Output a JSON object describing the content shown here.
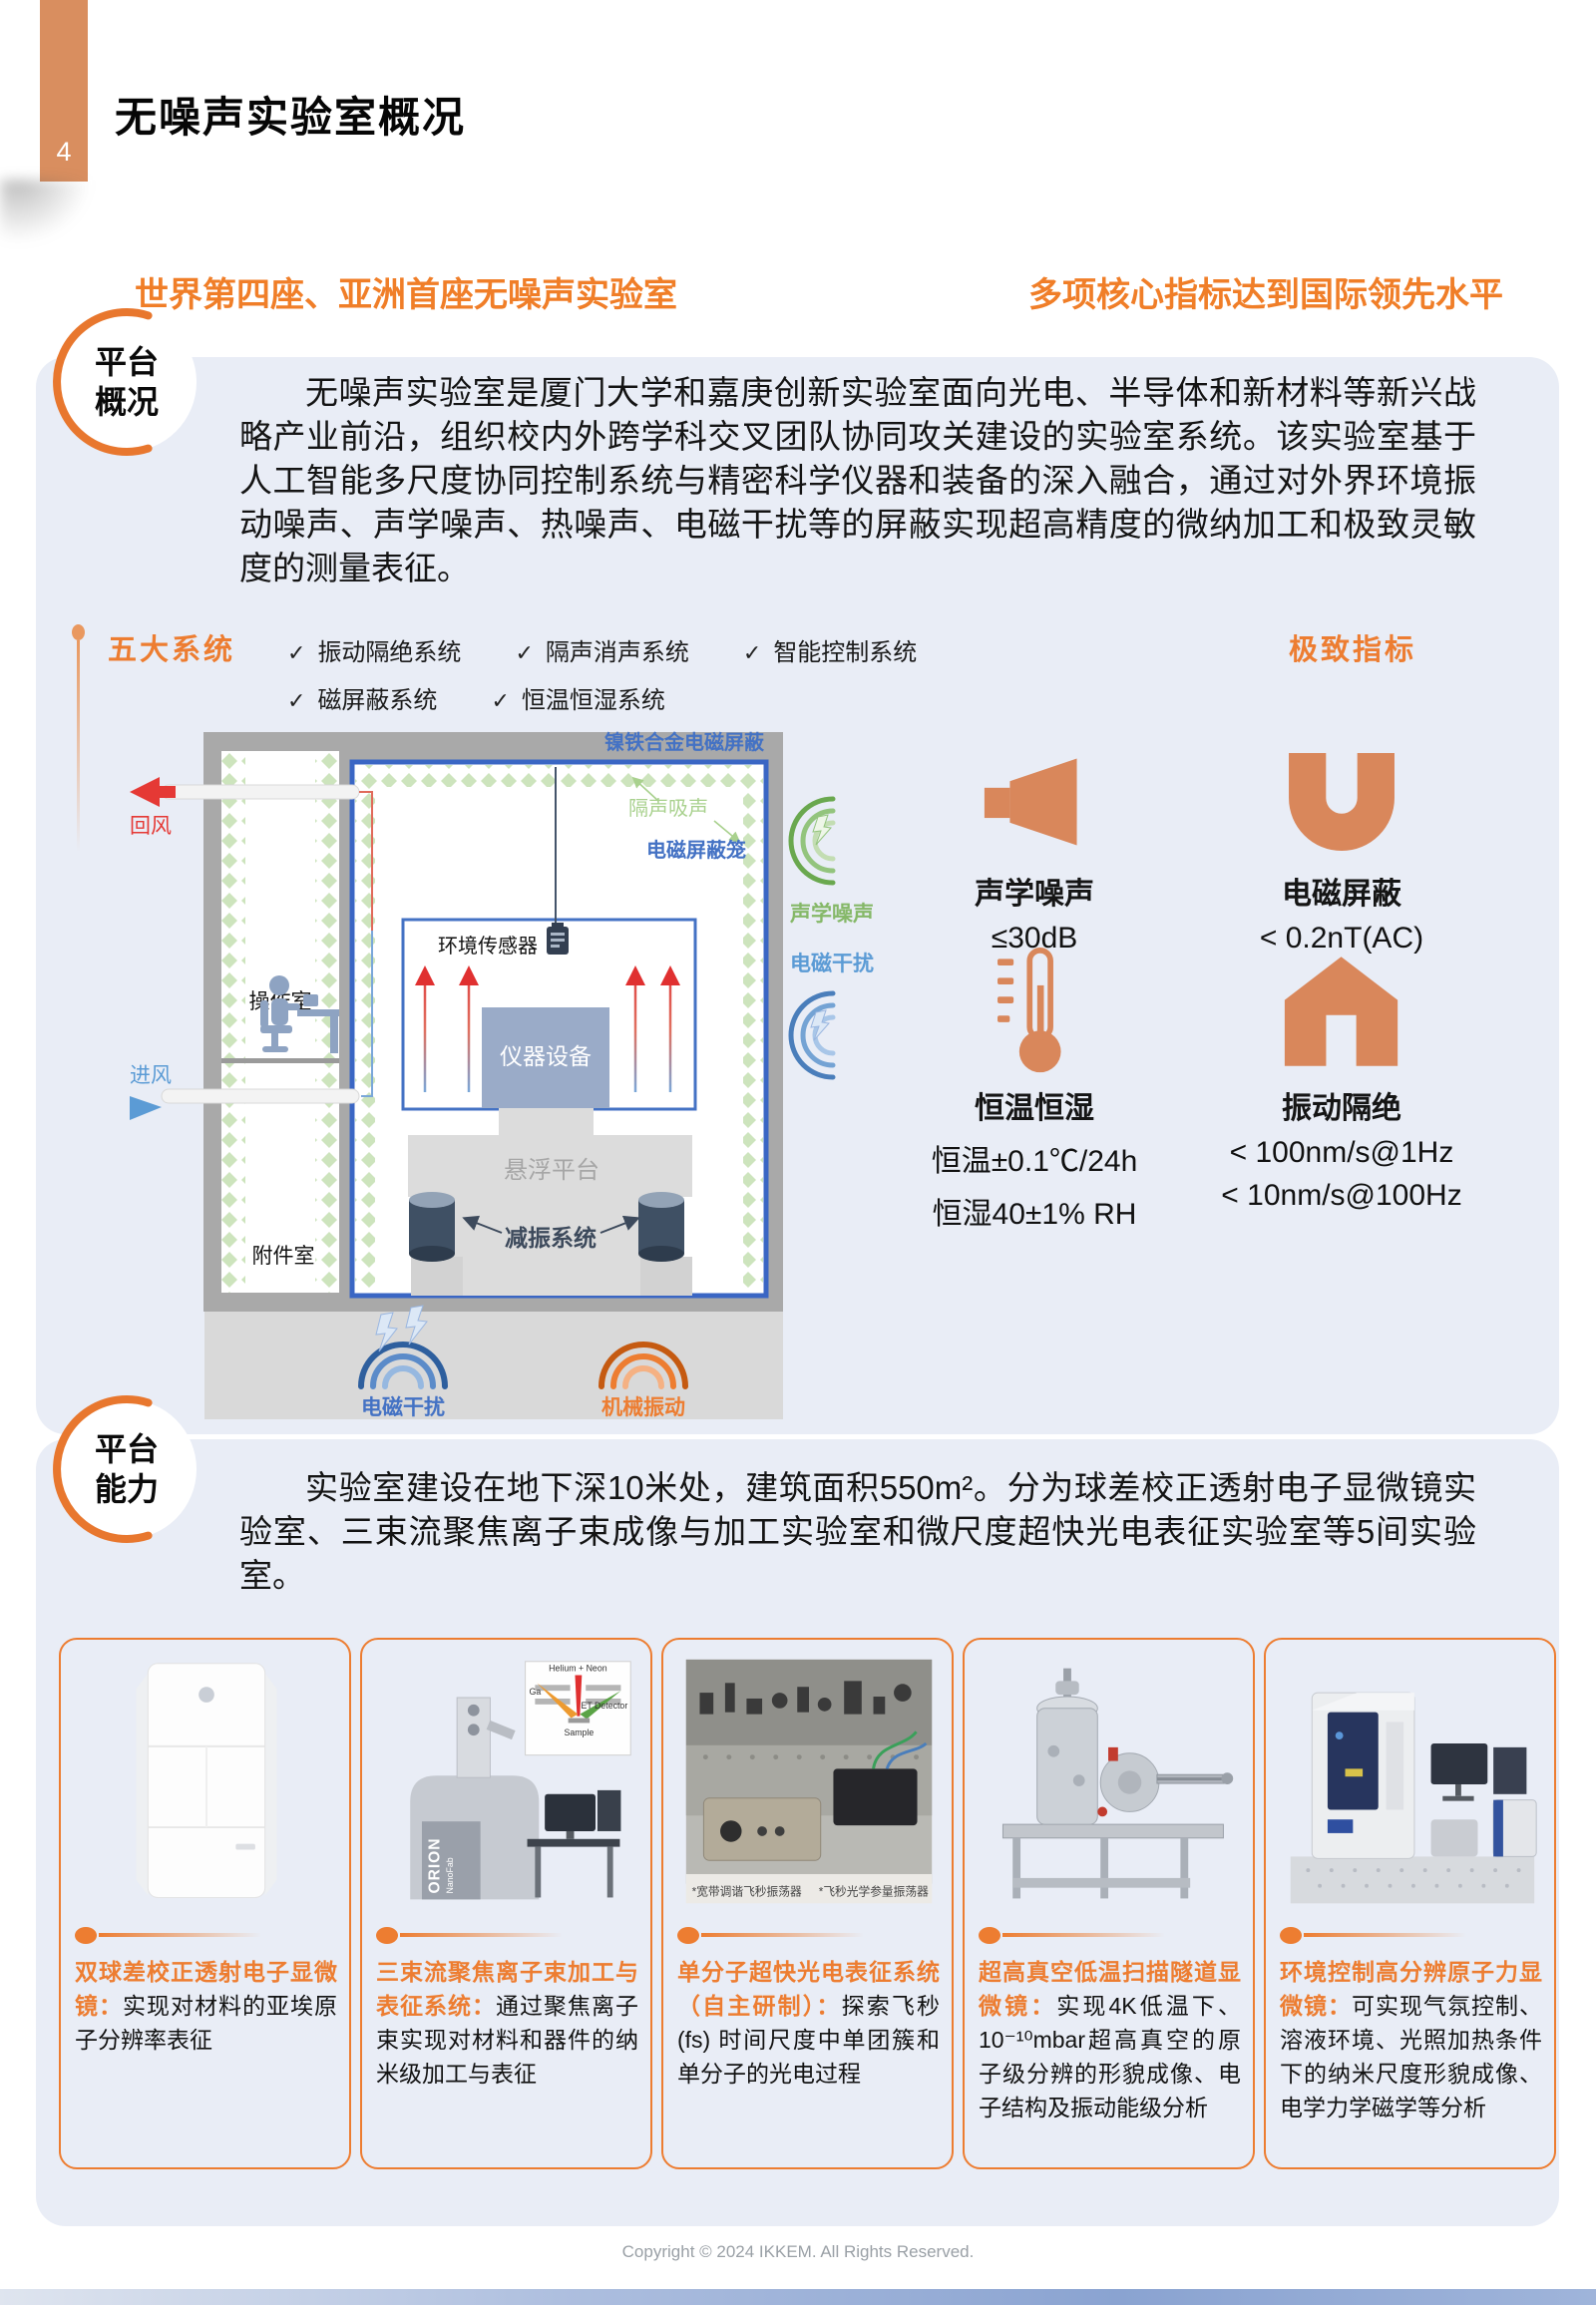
{
  "colors": {
    "accent": "#ED7D31",
    "tab_orange": "#D98E5F",
    "panel_blue": "#E9EDF6",
    "diagram_blue": "#4472C4",
    "diagram_green": "#A9D18E",
    "icon_orange": "#D9875B"
  },
  "page": {
    "number": "4",
    "title": "无噪声实验室概况",
    "headline_left": "世界第四座、亚洲首座无噪声实验室",
    "headline_right": "多项核心指标达到国际领先水平",
    "footer": "Copyright © 2024 IKKEM. All Rights Reserved."
  },
  "section1": {
    "badge": {
      "line1": "平台",
      "line2": "概况"
    },
    "paragraph": "无噪声实验室是厦门大学和嘉庚创新实验室面向光电、半导体和新材料等新兴战略产业前沿，组织校内外跨学科交叉团队协同攻关建设的实验室系统。该实验室基于人工智能多尺度协同控制系统与精密科学仪器和装备的深入融合，通过对外界环境振动噪声、声学噪声、热噪声、电磁干扰等的屏蔽实现超高精度的微纳加工和极致灵敏度的测量表征。",
    "systems_title": "五大系统",
    "check": "✓",
    "systems": [
      "振动隔绝系统",
      "隔声消声系统",
      "智能控制系统",
      "磁屏蔽系统",
      "恒温恒湿系统"
    ],
    "metrics_title": "极致指标",
    "diagram": {
      "shield": "镍铁合金电磁屏蔽",
      "absorb": "隔声吸声",
      "cage": "电磁屏蔽笼",
      "sensor": "环境传感器",
      "instrument": "仪器设备",
      "platform": "悬浮平台",
      "damper": "减振系统",
      "operation_room": "操作室",
      "accessory_room": "附件室",
      "return_air": "回风",
      "supply_air": "进风",
      "acoustic_noise": "声学噪声",
      "emi_side": "电磁干扰",
      "emi_bottom": "电磁干扰",
      "vibration_bottom": "机械振动"
    },
    "metrics": [
      {
        "icon": "speaker-icon",
        "label": "声学噪声",
        "values": [
          "≤30dB"
        ]
      },
      {
        "icon": "magnet-icon",
        "label": "电磁屏蔽",
        "values": [
          "< 0.2nT(AC)"
        ]
      },
      {
        "icon": "thermometer-icon",
        "label": "恒温恒湿",
        "values": [
          "恒温±0.1℃/24h",
          "恒湿40±1% RH"
        ]
      },
      {
        "icon": "house-icon",
        "label": "振动隔绝",
        "values": [
          "< 100nm/s@1Hz",
          "< 10nm/s@100Hz"
        ]
      }
    ]
  },
  "section2": {
    "badge": {
      "line1": "平台",
      "line2": "能力"
    },
    "paragraph": "实验室建设在地下深10米处，建筑面积550m²。分为球差校正透射电子显微镜实验室、三束流聚焦离子束成像与加工实验室和微尺度超快光电表征实验室等5间实验室。",
    "cards": [
      {
        "title": "双球差校正透射电子显微镜：",
        "desc": "实现对材料的亚埃原子分辨率表征"
      },
      {
        "title": "三束流聚焦离子束加工与表征系统：",
        "desc": "通过聚焦离子束实现对材料和器件的纳米级加工与表征",
        "machine": "ORION",
        "machine_sub": "NanoFab",
        "inset": {
          "beam": "Helium + Neon",
          "left": "Ga",
          "right": "ET Detector",
          "bottom": "Sample"
        }
      },
      {
        "title": "单分子超快光电表征系统（自主研制）：",
        "desc": "探索飞秒 (fs) 时间尺度中单团簇和单分子的光电过程",
        "captions": [
          "*宽带调谐飞秒振荡器",
          "*飞秒光学参量振荡器"
        ]
      },
      {
        "title": "超高真空低温扫描隧道显微镜：",
        "desc": "实现4K低温下、10⁻¹⁰mbar超高真空的原子级分辨的形貌成像、电子结构及振动能级分析"
      },
      {
        "title": "环境控制高分辨原子力显微镜：",
        "desc": "可实现气氛控制、溶液环境、光照加热条件下的纳米尺度形貌成像、电学力学磁学等分析"
      }
    ]
  }
}
